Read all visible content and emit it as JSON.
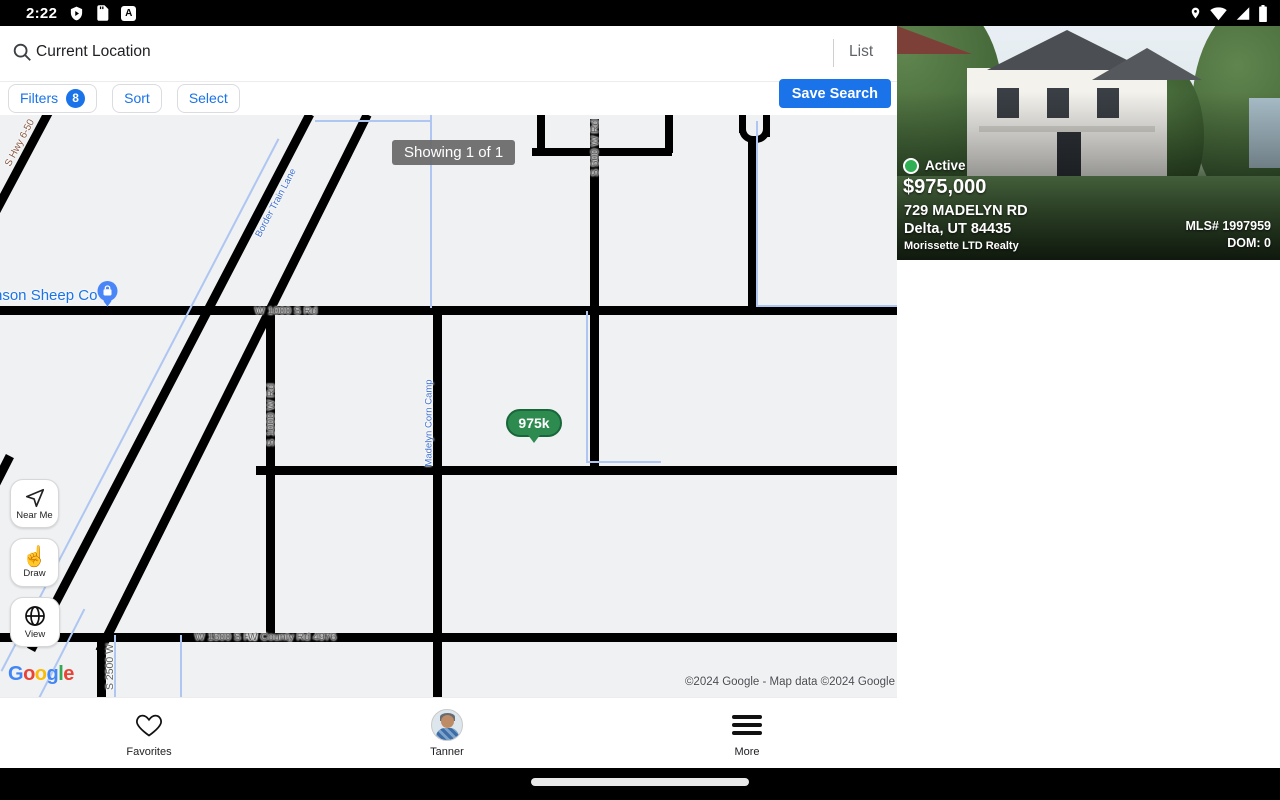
{
  "status_bar": {
    "time": "2:22",
    "a_icon": "A"
  },
  "header": {
    "search": {
      "value": "Current Location"
    },
    "list_label": "List",
    "filters": {
      "label": "Filters",
      "count": "8"
    },
    "sort_label": "Sort",
    "select_label": "Select",
    "save_search_label": "Save Search"
  },
  "map": {
    "showing_badge": "Showing 1 of 1",
    "price_marker": "975k",
    "controls": {
      "near_me": "Near Me",
      "draw": "Draw",
      "view": "View"
    },
    "poi_label": "nson Sheep Co",
    "road_labels": {
      "hwy": "S Hwy 6-50",
      "canal": "Border Train Lane",
      "w1000": "W 1000 S Rd",
      "s1000w": "S 1000 W Rd",
      "s500w": "S 500 W Rd",
      "madelyn": "Madelyn Corn Camp",
      "w1500": "W 1500 S Rd",
      "county": "W County Rd 4976",
      "s2500w": "S 2500 W"
    },
    "google": {
      "g1": "G",
      "o1": "o",
      "o2": "o",
      "g2": "g",
      "l": "l",
      "e": "e"
    },
    "copyright": "©2024 Google - Map data ©2024 Google"
  },
  "listing": {
    "status": "Active",
    "price": "$975,000",
    "address_line1": "729 MADELYN RD",
    "address_line2": "Delta, UT 84435",
    "brokerage": "Morissette LTD Realty",
    "mls": "MLS# 1997959",
    "dom": "DOM: 0"
  },
  "bottom_nav": {
    "favorites": "Favorites",
    "profile": "Tanner",
    "more": "More"
  },
  "colors": {
    "accent": "#1a73e8",
    "marker_green": "#2e8b50",
    "active_green": "#2fae54"
  }
}
